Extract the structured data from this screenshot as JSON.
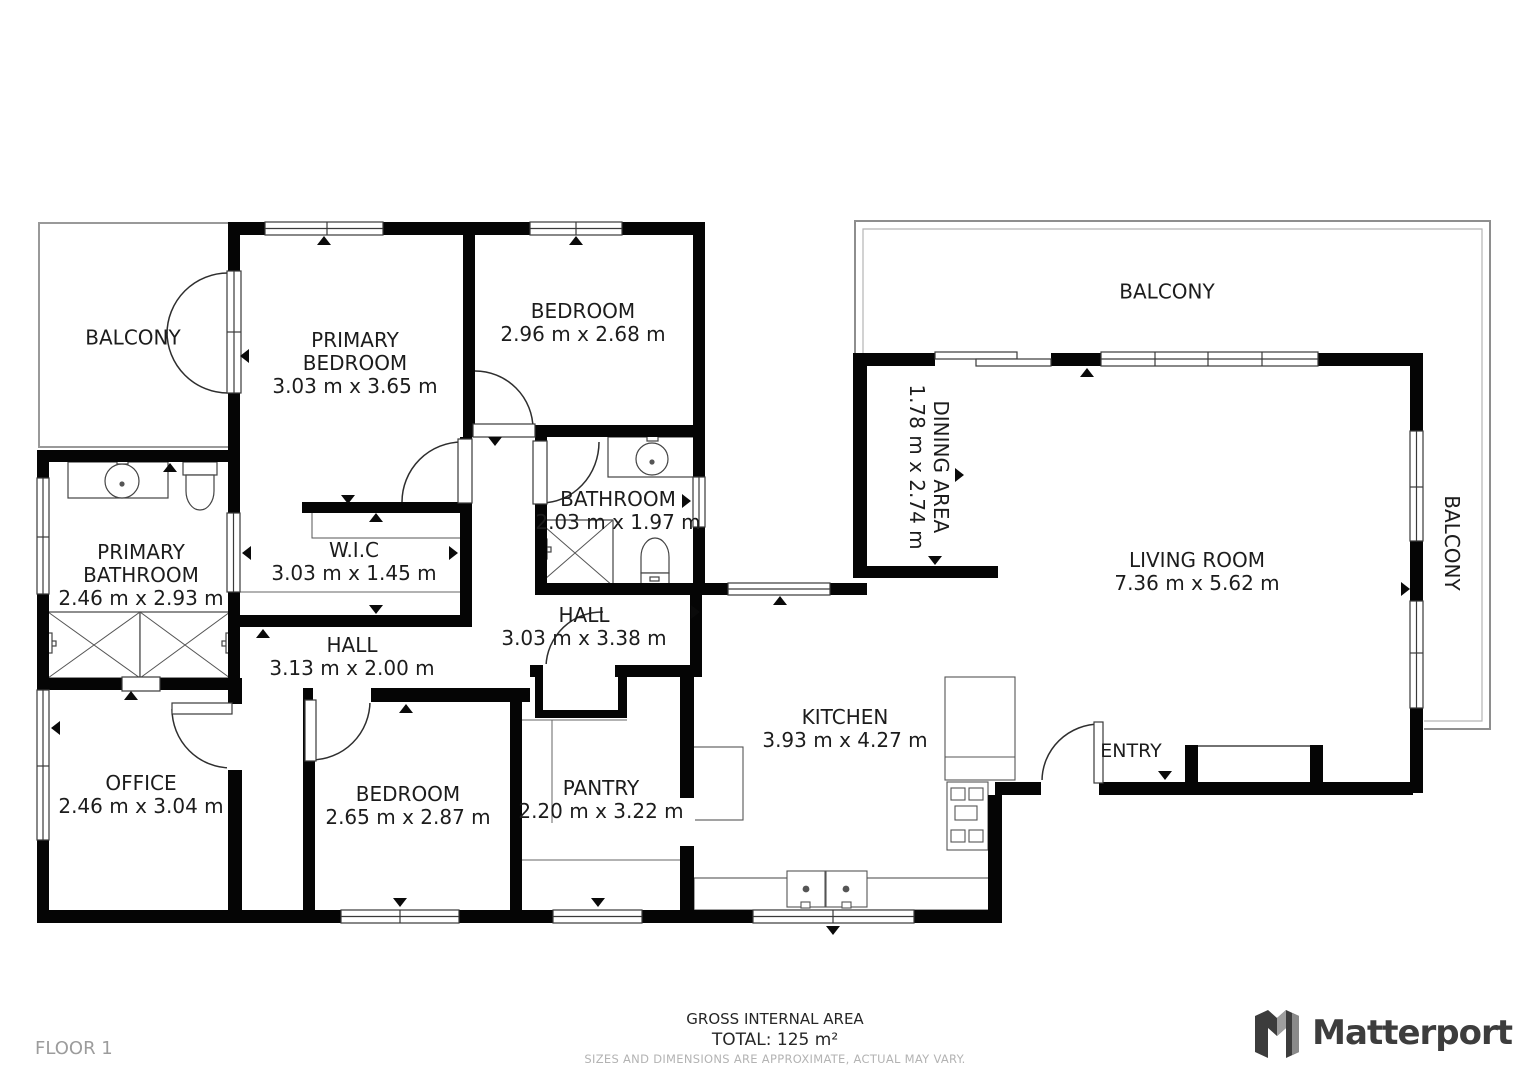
{
  "floor_label": "FLOOR 1",
  "footer": {
    "line1": "GROSS INTERNAL AREA",
    "line2": "TOTAL: 125 m²",
    "line3": "SIZES AND DIMENSIONS ARE APPROXIMATE, ACTUAL MAY VARY."
  },
  "brand": {
    "name": "Matterport"
  },
  "colors": {
    "wall": "#050505",
    "label": "#1c1c1c",
    "muted": "#9c9c9c",
    "rail": "#999999"
  },
  "rooms": [
    {
      "id": "balcony-top-left",
      "name": "BALCONY",
      "dims": ""
    },
    {
      "id": "primary-bedroom",
      "name": "PRIMARY BEDROOM",
      "dims": "3.03 m x 3.65 m"
    },
    {
      "id": "bedroom-top",
      "name": "BEDROOM",
      "dims": "2.96 m x 2.68 m"
    },
    {
      "id": "bathroom",
      "name": "BATHROOM",
      "dims": "2.03 m x 1.97 m"
    },
    {
      "id": "balcony-top-right",
      "name": "BALCONY",
      "dims": ""
    },
    {
      "id": "dining-area",
      "name": "DINING AREA",
      "dims": "1.78 m x 2.74 m"
    },
    {
      "id": "living-room",
      "name": "LIVING ROOM",
      "dims": "7.36 m x 5.62 m"
    },
    {
      "id": "balcony-right",
      "name": "BALCONY",
      "dims": ""
    },
    {
      "id": "primary-bathroom",
      "name": "PRIMARY BATHROOM",
      "dims": "2.46 m x 2.93 m"
    },
    {
      "id": "wic",
      "name": "W.I.C",
      "dims": "3.03 m x 1.45 m"
    },
    {
      "id": "hall-small",
      "name": "HALL",
      "dims": "3.13 m x 2.00 m"
    },
    {
      "id": "hall-large",
      "name": "HALL",
      "dims": "3.03 m x 3.38 m"
    },
    {
      "id": "office",
      "name": "OFFICE",
      "dims": "2.46 m x 3.04 m"
    },
    {
      "id": "bedroom-bottom",
      "name": "BEDROOM",
      "dims": "2.65 m x 2.87 m"
    },
    {
      "id": "pantry",
      "name": "PANTRY",
      "dims": "2.20 m x 3.22 m"
    },
    {
      "id": "kitchen",
      "name": "KITCHEN",
      "dims": "3.93 m x 4.27 m"
    },
    {
      "id": "entry",
      "name": "ENTRY",
      "dims": ""
    }
  ]
}
